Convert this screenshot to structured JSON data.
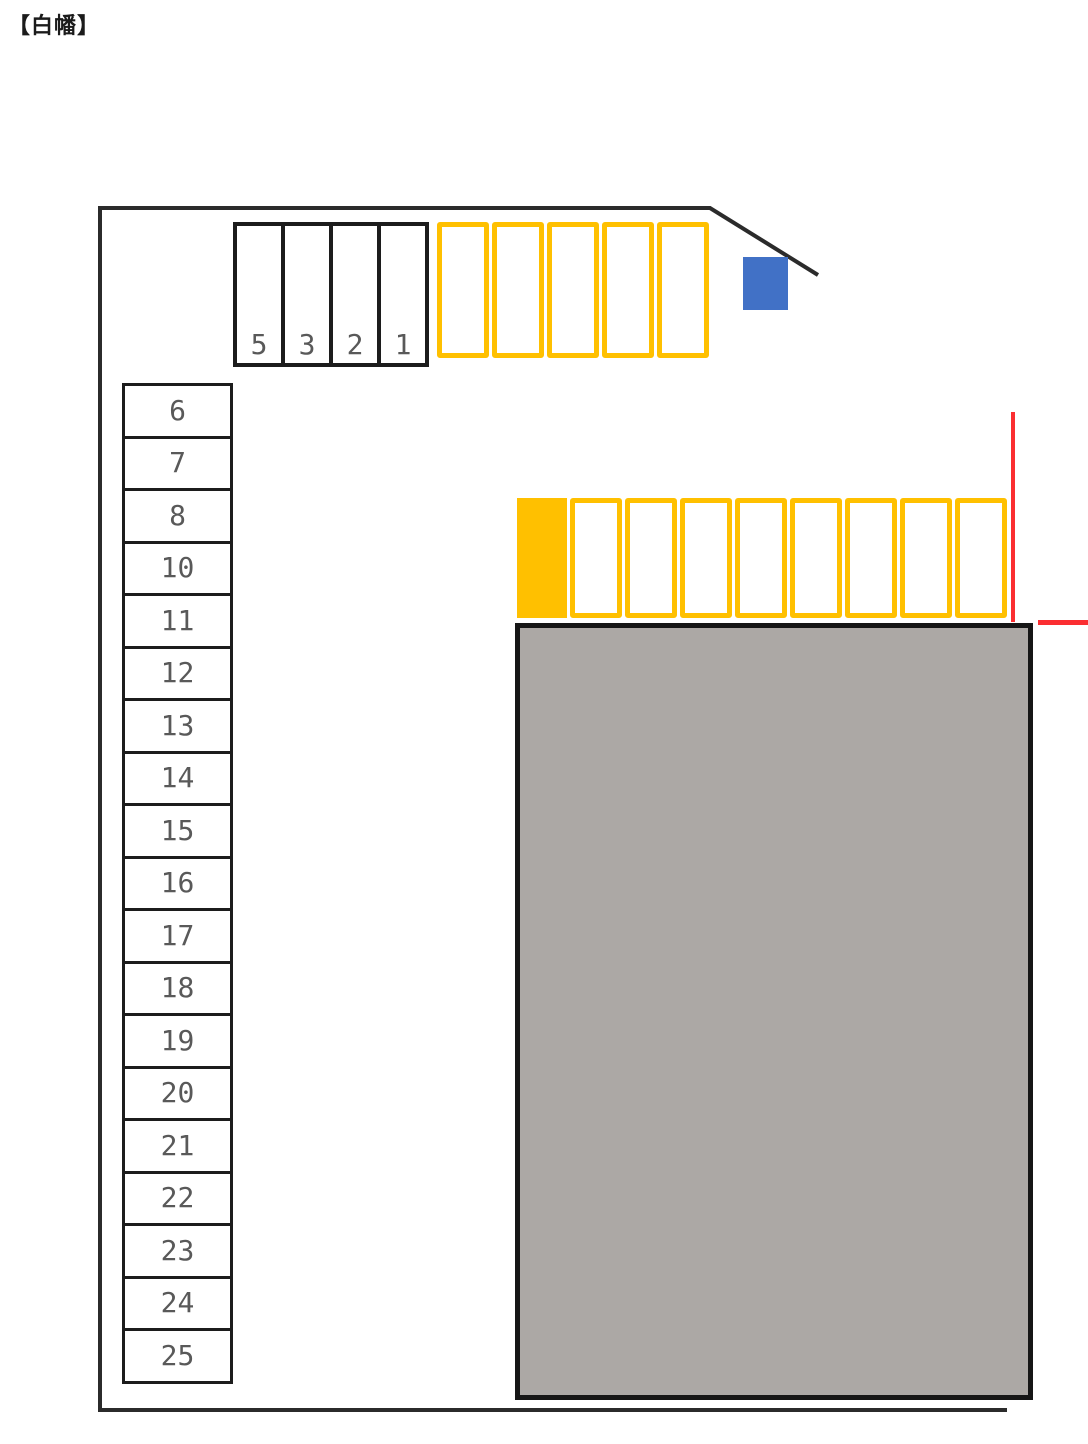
{
  "title": "【白幡】",
  "colors": {
    "yellow": "#FFC000",
    "blue": "#4171C6",
    "red": "#FB2E31",
    "boundary": "#2B2B2B",
    "stall-border": "#1C1C1C",
    "building-fill": "#ACA8A5",
    "building-border": "#161616",
    "number-gray": "#595959",
    "title-color": "#1B1B1B"
  },
  "top_row": {
    "black_stalls": [
      "5",
      "3",
      "2",
      "1"
    ],
    "yellow_stall_count": 5
  },
  "middle_row": {
    "filled_stall_count": 1,
    "outlined_stall_count": 8
  },
  "left_column": {
    "stalls": [
      "6",
      "7",
      "8",
      "10",
      "11",
      "12",
      "13",
      "14",
      "15",
      "16",
      "17",
      "18",
      "19",
      "20",
      "21",
      "22",
      "23",
      "24",
      "25"
    ]
  }
}
